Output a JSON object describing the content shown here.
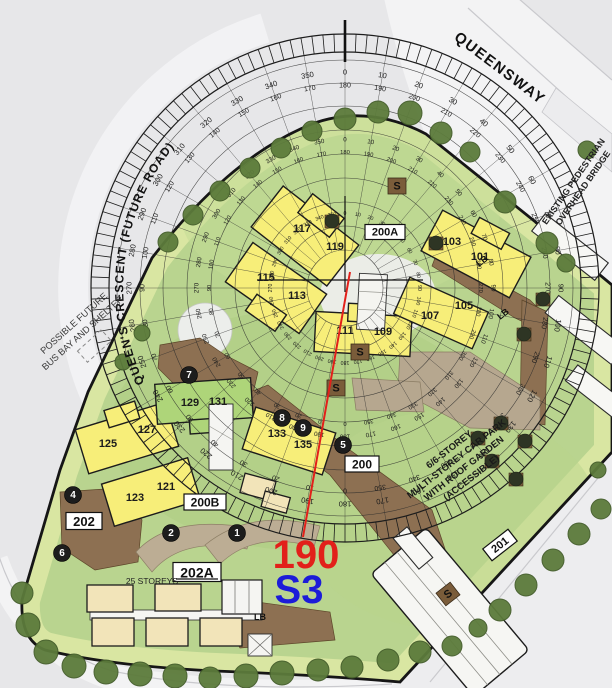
{
  "labels": {
    "queensway": "QUEENSWAY",
    "crescent": "QUEEN'S CRESCENT (FUTURE ROAD)",
    "bus_bay": [
      "POSSIBLE FUTURE",
      "BUS BAY AND SHELTER"
    ],
    "bridge": [
      "EXISTING PEDESTRIAN",
      "OVERHEAD BRIDGE"
    ],
    "carpark": [
      "6/6-STOREY",
      "MULTI-STOREY CAR PARK",
      "WITH ROOF GARDEN",
      "(ACCESSIBLE)"
    ],
    "storeys": "25 STOREYS"
  },
  "bearing": {
    "value": "190",
    "sector": "S3",
    "angle_deg": 190,
    "value_color": "#e2201a",
    "sector_color": "#1c1cd8"
  },
  "compass": {
    "center": {
      "x": 345,
      "y": 288
    },
    "ring_radii": [
      38,
      62,
      86,
      110,
      134,
      158,
      182,
      205,
      228
    ],
    "band_inner": 236,
    "band_outer": 254,
    "degrees": [
      0,
      10,
      20,
      30,
      40,
      50,
      60,
      70,
      80,
      90,
      100,
      110,
      120,
      130,
      140,
      150,
      160,
      170,
      180,
      190,
      200,
      210,
      220,
      230,
      240,
      250,
      260,
      270,
      280,
      290,
      300,
      310,
      320,
      330,
      340,
      350
    ],
    "label_rings": [
      {
        "main_r": 216,
        "recip_r": 202,
        "size": 7.6,
        "recip_size": 7
      },
      {
        "main_r": 148,
        "recip_r": 135,
        "size": 6.2,
        "recip_size": 5.8
      },
      {
        "main_r": 74,
        "recip_r": 0,
        "size": 5.2,
        "recip_size": 0
      }
    ]
  },
  "buildings": [
    {
      "label": "117",
      "x": 302,
      "y": 229
    },
    {
      "label": "119",
      "x": 335,
      "y": 247
    },
    {
      "label": "115",
      "x": 266,
      "y": 278
    },
    {
      "label": "113",
      "x": 297,
      "y": 296
    },
    {
      "label": "111",
      "x": 345,
      "y": 331
    },
    {
      "label": "109",
      "x": 383,
      "y": 332
    },
    {
      "label": "101",
      "x": 480,
      "y": 257
    },
    {
      "label": "103",
      "x": 452,
      "y": 242
    },
    {
      "label": "105",
      "x": 464,
      "y": 306
    },
    {
      "label": "107",
      "x": 430,
      "y": 316
    },
    {
      "label": "125",
      "x": 108,
      "y": 444
    },
    {
      "label": "127",
      "x": 147,
      "y": 430
    },
    {
      "label": "129",
      "x": 190,
      "y": 403
    },
    {
      "label": "131",
      "x": 218,
      "y": 402
    },
    {
      "label": "121",
      "x": 166,
      "y": 487
    },
    {
      "label": "123",
      "x": 135,
      "y": 498
    },
    {
      "label": "133",
      "x": 277,
      "y": 434
    },
    {
      "label": "135",
      "x": 303,
      "y": 445
    }
  ],
  "boxed_labels": [
    {
      "label": "200A",
      "x": 385,
      "y": 232,
      "w": 40,
      "h": 15,
      "size": 11,
      "rot": 0,
      "underline": false
    },
    {
      "label": "200B",
      "x": 205,
      "y": 502,
      "w": 42,
      "h": 16,
      "size": 12,
      "rot": 0,
      "underline": false
    },
    {
      "label": "200",
      "x": 362,
      "y": 464,
      "w": 34,
      "h": 16,
      "size": 12,
      "rot": 0,
      "underline": false
    },
    {
      "label": "202",
      "x": 84,
      "y": 521,
      "w": 36,
      "h": 17,
      "size": 13,
      "rot": 0,
      "underline": false
    },
    {
      "label": "201",
      "x": 500,
      "y": 545,
      "w": 32,
      "h": 15,
      "size": 11,
      "rot": -38,
      "underline": false
    },
    {
      "label": "202A",
      "x": 197,
      "y": 572,
      "w": 48,
      "h": 19,
      "size": 14,
      "rot": 0,
      "underline": true
    }
  ],
  "circled_numbers": [
    {
      "label": "1",
      "x": 237,
      "y": 533
    },
    {
      "label": "2",
      "x": 171,
      "y": 533
    },
    {
      "label": "4",
      "x": 73,
      "y": 495
    },
    {
      "label": "5",
      "x": 343,
      "y": 445
    },
    {
      "label": "6",
      "x": 62,
      "y": 553
    },
    {
      "label": "7",
      "x": 189,
      "y": 375
    },
    {
      "label": "8",
      "x": 282,
      "y": 418
    },
    {
      "label": "9",
      "x": 303,
      "y": 428
    }
  ],
  "s_markers": [
    {
      "label": "S",
      "x": 397,
      "y": 186,
      "rot": 0
    },
    {
      "label": "S",
      "x": 360,
      "y": 352,
      "rot": 0
    },
    {
      "label": "S",
      "x": 336,
      "y": 388,
      "rot": 0
    },
    {
      "label": "S",
      "x": 448,
      "y": 594,
      "rot": -38
    }
  ],
  "lb_markers": [
    {
      "label": "LB",
      "x": 260,
      "y": 617,
      "rot": 0
    },
    {
      "label": "LB",
      "x": 482,
      "y": 261,
      "rot": -38
    },
    {
      "label": "LB",
      "x": 503,
      "y": 314,
      "rot": -38
    }
  ],
  "trees": [
    {
      "x": 168,
      "y": 242,
      "r": 10
    },
    {
      "x": 193,
      "y": 215,
      "r": 10
    },
    {
      "x": 220,
      "y": 191,
      "r": 10
    },
    {
      "x": 250,
      "y": 168,
      "r": 10
    },
    {
      "x": 281,
      "y": 148,
      "r": 10
    },
    {
      "x": 312,
      "y": 131,
      "r": 10
    },
    {
      "x": 345,
      "y": 119,
      "r": 11
    },
    {
      "x": 378,
      "y": 112,
      "r": 11
    },
    {
      "x": 410,
      "y": 113,
      "r": 12
    },
    {
      "x": 441,
      "y": 133,
      "r": 11
    },
    {
      "x": 470,
      "y": 152,
      "r": 10
    },
    {
      "x": 505,
      "y": 202,
      "r": 11
    },
    {
      "x": 547,
      "y": 243,
      "r": 11
    },
    {
      "x": 566,
      "y": 263,
      "r": 9
    },
    {
      "x": 587,
      "y": 150,
      "r": 9
    },
    {
      "x": 142,
      "y": 333,
      "r": 8
    },
    {
      "x": 123,
      "y": 362,
      "r": 8
    },
    {
      "x": 22,
      "y": 593,
      "r": 11
    },
    {
      "x": 28,
      "y": 625,
      "r": 12
    },
    {
      "x": 46,
      "y": 652,
      "r": 12
    },
    {
      "x": 74,
      "y": 666,
      "r": 12
    },
    {
      "x": 106,
      "y": 672,
      "r": 12
    },
    {
      "x": 140,
      "y": 674,
      "r": 12
    },
    {
      "x": 175,
      "y": 676,
      "r": 12
    },
    {
      "x": 210,
      "y": 678,
      "r": 11
    },
    {
      "x": 246,
      "y": 676,
      "r": 12
    },
    {
      "x": 282,
      "y": 673,
      "r": 12
    },
    {
      "x": 318,
      "y": 670,
      "r": 11
    },
    {
      "x": 352,
      "y": 667,
      "r": 11
    },
    {
      "x": 388,
      "y": 660,
      "r": 11
    },
    {
      "x": 420,
      "y": 652,
      "r": 11
    },
    {
      "x": 452,
      "y": 646,
      "r": 10
    },
    {
      "x": 478,
      "y": 628,
      "r": 9
    },
    {
      "x": 500,
      "y": 610,
      "r": 11
    },
    {
      "x": 526,
      "y": 585,
      "r": 11
    },
    {
      "x": 553,
      "y": 560,
      "r": 11
    },
    {
      "x": 579,
      "y": 534,
      "r": 11
    },
    {
      "x": 601,
      "y": 509,
      "r": 10
    },
    {
      "x": 598,
      "y": 470,
      "r": 8
    }
  ],
  "dark_features": [
    {
      "x": 332,
      "y": 221
    },
    {
      "x": 436,
      "y": 243
    },
    {
      "x": 543,
      "y": 299
    },
    {
      "x": 524,
      "y": 334
    },
    {
      "x": 478,
      "y": 438
    },
    {
      "x": 501,
      "y": 423
    },
    {
      "x": 525,
      "y": 441
    },
    {
      "x": 492,
      "y": 461
    },
    {
      "x": 516,
      "y": 479
    }
  ]
}
